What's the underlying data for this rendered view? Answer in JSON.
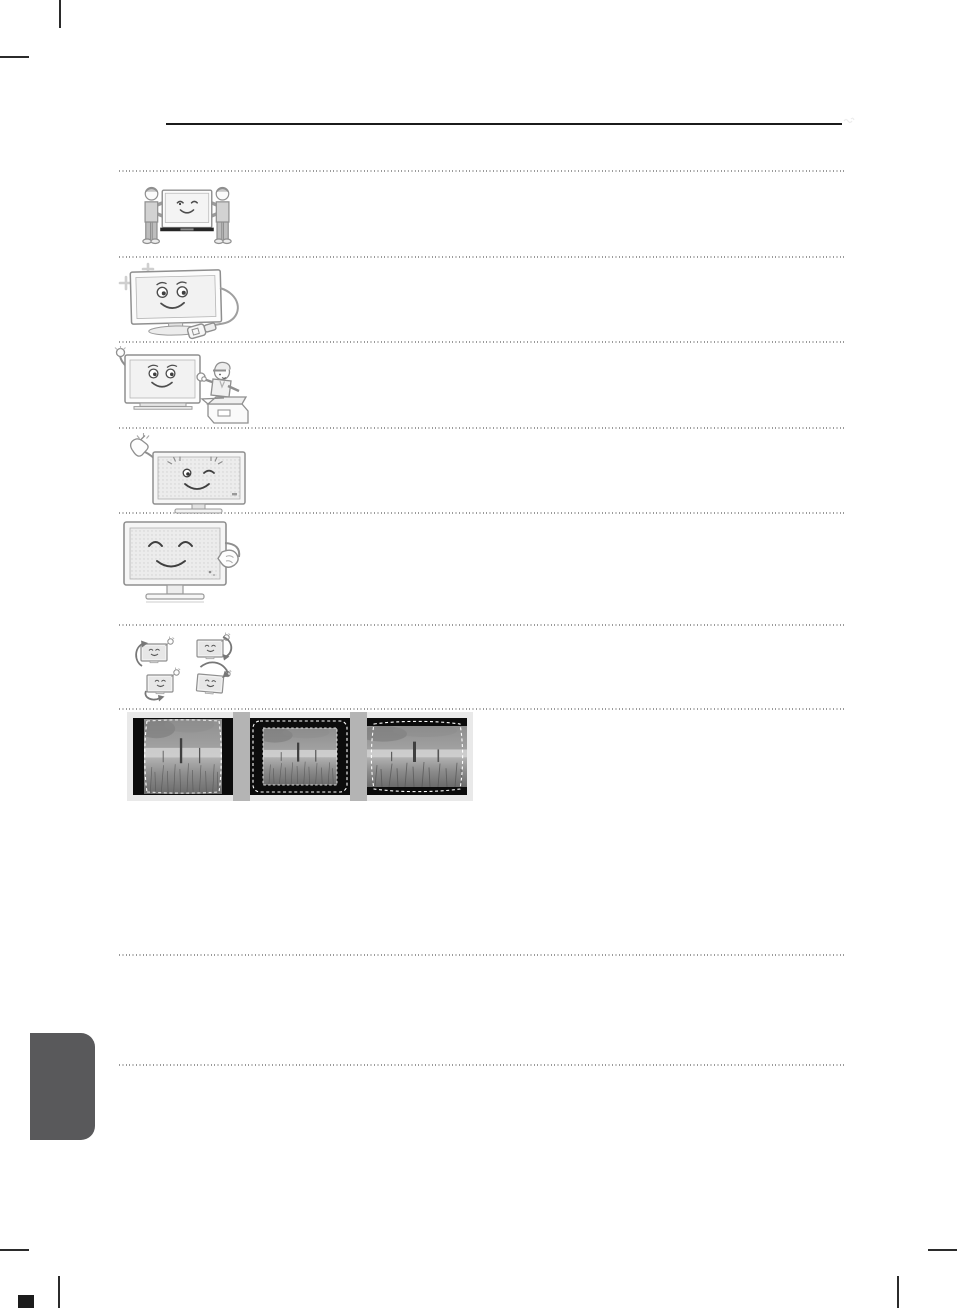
{
  "document": {
    "kind": "user-manual page (scanned, pictograms only, no text)",
    "background": "#ffffff",
    "header_rule_color": "#1b1b1b",
    "separator_color": "#9a9a9a",
    "separator_style": "dotted",
    "side_tab_color": "#59595b",
    "crop_mark_color": "#2b2b2b"
  },
  "illustrations": [
    {
      "name": "two-people-carrying-tv-illustration",
      "description": "Two people carrying a smiling flat-screen TV together"
    },
    {
      "name": "tv-sparkling-unplugged-cord-illustration",
      "description": "Smiling TV with sparkles and a power cord unplugged on the floor"
    },
    {
      "name": "tv-waving-packing-carton-illustration",
      "description": "TV waving while a worker points at an open shipping carton"
    },
    {
      "name": "hand-snap-winking-tv-illustration",
      "description": "Hand snapping fingers beside a winking dotted-screen TV"
    },
    {
      "name": "hand-patting-happy-tv-illustration",
      "description": "Hand patting a content TV with closed eyes and dotted screen"
    },
    {
      "name": "four-tvs-rotation-arrows-illustration",
      "description": "Four small TVs with curved arrows showing rotation directions"
    }
  ],
  "screen_examples": {
    "strip_background": "#e9e9e9",
    "divider_color": "#b4b4b4",
    "frames": [
      {
        "name": "pillarbox-picture-example",
        "description": "Landscape photo with black side bars and dashed vertical guides"
      },
      {
        "name": "windowbox-picture-example",
        "description": "Landscape photo with black border all around and two dashed outlines"
      },
      {
        "name": "letterbox-picture-example",
        "description": "Landscape photo with black top and bottom bars and a dashed wide outline"
      }
    ]
  }
}
